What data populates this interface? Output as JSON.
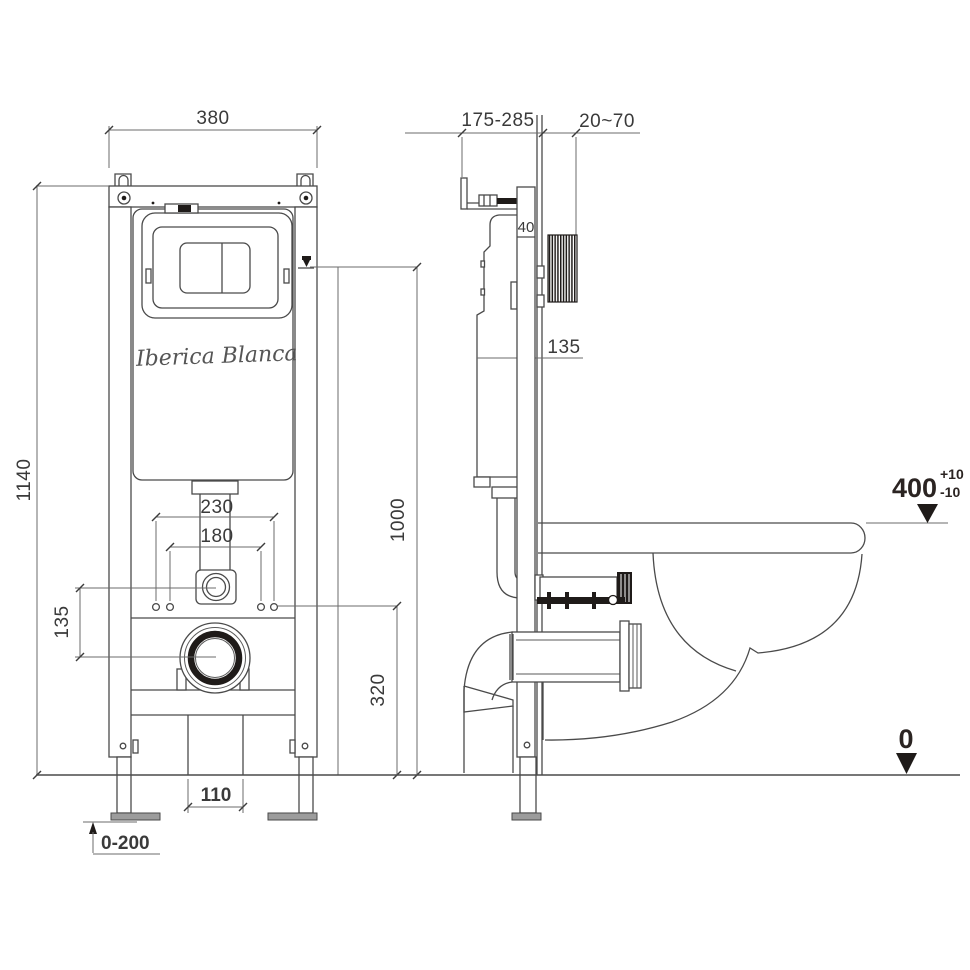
{
  "brand": "Iberica Blanca",
  "front_view": {
    "frame_width": "380",
    "frame_height": "1140",
    "flush_outlet_offset": "135",
    "fixing_width_outer": "230",
    "fixing_width_inner": "180",
    "outlet_height": "320",
    "flush_plate_height": "1000",
    "waste_pipe_width": "110",
    "feet_adjust_range": "0-200"
  },
  "side_view": {
    "install_depth_range": "175-285",
    "wall_finish_range": "20~70",
    "frame_profile_depth": "40",
    "inlet_offset": "135",
    "seat_height": "400",
    "seat_tol_plus": "+10",
    "seat_tol_minus": "-10",
    "floor_level": "0"
  }
}
